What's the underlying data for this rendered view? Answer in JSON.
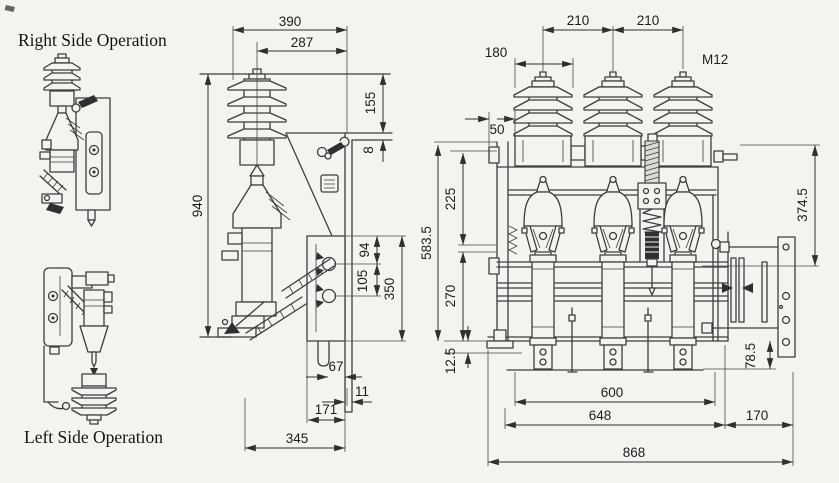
{
  "captions": {
    "right_side": "Right Side Operation",
    "left_side": "Left Side Operation"
  },
  "side_view_dims": {
    "d390": "390",
    "d287": "287",
    "d155": "155",
    "d8": "8",
    "d940": "940",
    "d94": "94",
    "d105": "105",
    "d350": "350",
    "d67": "67",
    "d11": "11",
    "d171": "171",
    "d345": "345"
  },
  "front_view_dims": {
    "d210a": "210",
    "d210b": "210",
    "d180": "180",
    "m12": "M12",
    "d50": "50",
    "d225": "225",
    "d270": "270",
    "d583": "583.5",
    "d125": "12.5",
    "d374": "374.5",
    "d785": "78.5",
    "d600": "600",
    "d648": "648",
    "d170": "170",
    "d868": "868"
  },
  "colors": {
    "background": "#f4f3ef",
    "line": "#3d3d3d",
    "text": "#1d1d1d"
  }
}
